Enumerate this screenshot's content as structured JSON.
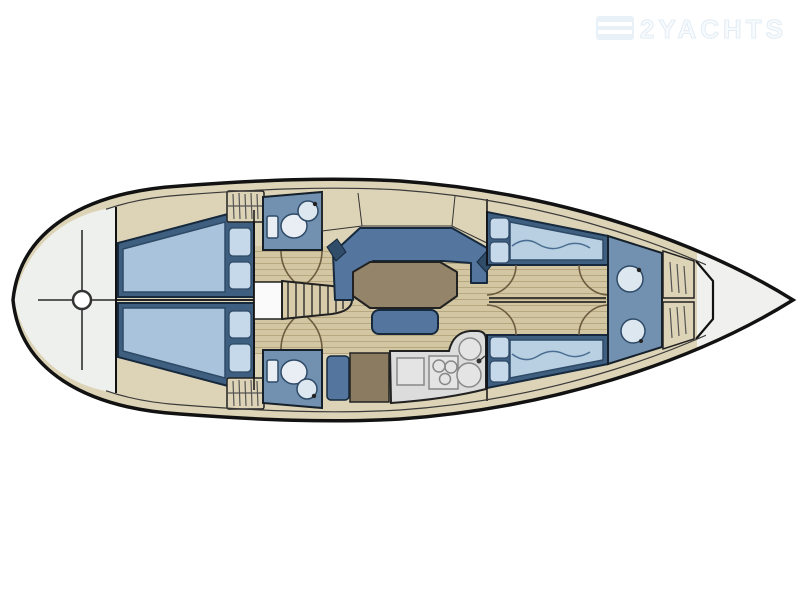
{
  "watermark": {
    "brand": "2YACHTS",
    "icon": "flag-stripes-icon"
  },
  "palette": {
    "hull_outline": "#121212",
    "deck": "#ddd3b6",
    "floor": "#d3c6a2",
    "floor_line": "#b7a880",
    "stern_deck": "#eef0ed",
    "bow_tip": "#f0f1ee",
    "settee_blue": "#53759e",
    "settee_dark": "#2f4c68",
    "berth_frame": "#3f5f80",
    "mattress": "#a9c3dc",
    "cushion": "#c6d9ea",
    "head_floor": "#7291b1",
    "fixture": "#e3ecf3",
    "table": "#94846a",
    "chart_table": "#8b7b60",
    "counter": "#dcdcdc",
    "steps": "#d8cbaa",
    "door_arc": "#6b5c40",
    "companionway_white": "#fafafa"
  },
  "diagram": {
    "type": "sailing-yacht-accommodation-plan",
    "orientation": {
      "bow": "right",
      "stern": "left"
    },
    "compartments": [
      "stern-deck-with-helm",
      "aft-cabin-top",
      "aft-cabin-bottom",
      "head-top",
      "head-bottom",
      "companionway",
      "salon-with-u-settee-and-table",
      "nav-station",
      "galley",
      "forward-berth-top",
      "forward-berth-bottom",
      "forward-corridor",
      "bow-head",
      "bow-lockers",
      "anchor-locker-bow-tip"
    ],
    "fixtures": [
      "helm-crosshair",
      "toilet",
      "washbasin",
      "stove-3-burner",
      "double-sink",
      "fridge",
      "companionway-steps",
      "hanging-lockers",
      "salon-table",
      "settee-bench",
      "chart-table",
      "pillows",
      "mattress-wave"
    ]
  }
}
